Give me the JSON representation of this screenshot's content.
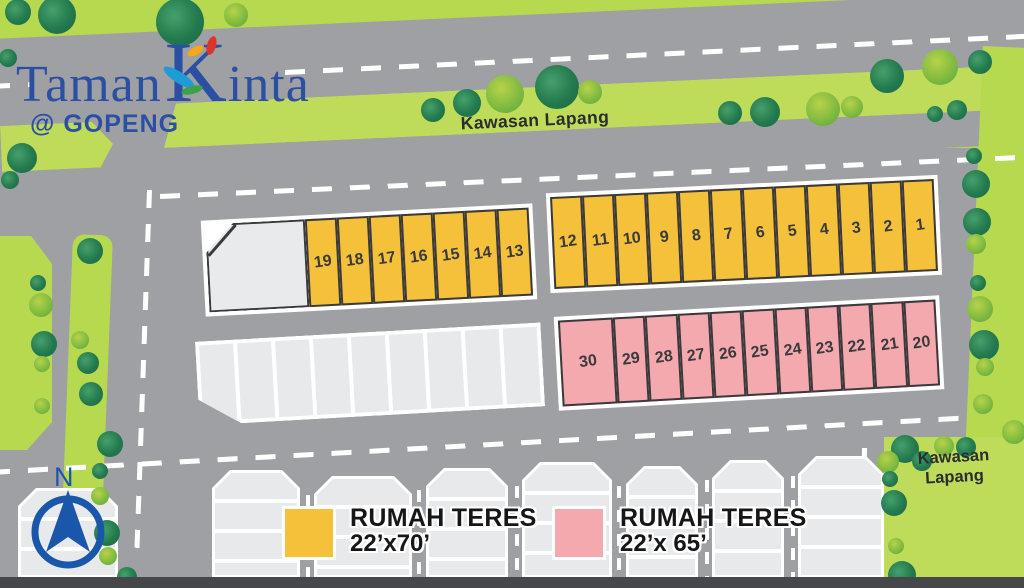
{
  "logo": {
    "word1": "Taman",
    "k": "K",
    "word2": "inta",
    "subtitle": "@ GOPENG",
    "color": "#2b4fa3"
  },
  "labels": {
    "road_top": "Kawasan Lapang",
    "area_bottom_right_line1": "Kawasan",
    "area_bottom_right_line2": "Lapang",
    "compass_n": "N"
  },
  "legend": {
    "items": [
      {
        "swatch_color": "#f6c13a",
        "name": "RUMAH TERES",
        "size": "22’x70’"
      },
      {
        "swatch_color": "#f4a9ae",
        "name": "RUMAH TERES",
        "size": "22’x 65’"
      }
    ]
  },
  "site": {
    "strips": {
      "terrace70_left": {
        "house_type": "RUMAH TERES 22'x70'",
        "color": "#f6c13a",
        "corner_lot_first": true,
        "numbers": [
          "19",
          "18",
          "17",
          "16",
          "15",
          "14",
          "13"
        ]
      },
      "terrace70_right": {
        "house_type": "RUMAH TERES 22'x70'",
        "color": "#f6c13a",
        "corner_lot_first": false,
        "numbers": [
          "12",
          "11",
          "10",
          "9",
          "8",
          "7",
          "6",
          "5",
          "4",
          "3",
          "2",
          "1"
        ]
      },
      "terrace65": {
        "house_type": "RUMAH TERES 22'x 65'",
        "color": "#f4a9ae",
        "corner_lot_first": false,
        "first_wide": true,
        "numbers": [
          "30",
          "29",
          "28",
          "27",
          "26",
          "25",
          "24",
          "23",
          "22",
          "21",
          "20"
        ]
      },
      "unlabeled": {
        "color": "#e8e9eb",
        "count": 9
      }
    }
  },
  "colors": {
    "grass": "#b6d950",
    "road": "#9ea0a3",
    "lot_outline": "#3a3a3c",
    "terrace70": "#f6c13a",
    "terrace65": "#f4a9ae",
    "logo_blue": "#2b4fa3",
    "compass_blue": "#1a57ab"
  },
  "decor": {
    "trees": [
      {
        "x": 18,
        "y": 12,
        "r": 13,
        "t": "d"
      },
      {
        "x": 57,
        "y": 15,
        "r": 19,
        "t": "d"
      },
      {
        "x": 180,
        "y": 22,
        "r": 24,
        "t": "d"
      },
      {
        "x": 236,
        "y": 15,
        "r": 12,
        "t": "l"
      },
      {
        "x": 8,
        "y": 58,
        "r": 9,
        "t": "d"
      },
      {
        "x": 22,
        "y": 158,
        "r": 15,
        "t": "d"
      },
      {
        "x": 10,
        "y": 180,
        "r": 9,
        "t": "d"
      },
      {
        "x": 433,
        "y": 110,
        "r": 12,
        "t": "d"
      },
      {
        "x": 467,
        "y": 103,
        "r": 14,
        "t": "d"
      },
      {
        "x": 505,
        "y": 94,
        "r": 19,
        "t": "l"
      },
      {
        "x": 557,
        "y": 87,
        "r": 22,
        "t": "d"
      },
      {
        "x": 590,
        "y": 92,
        "r": 12,
        "t": "l"
      },
      {
        "x": 730,
        "y": 113,
        "r": 12,
        "t": "d"
      },
      {
        "x": 765,
        "y": 112,
        "r": 15,
        "t": "d"
      },
      {
        "x": 823,
        "y": 109,
        "r": 17,
        "t": "l"
      },
      {
        "x": 852,
        "y": 107,
        "r": 11,
        "t": "l"
      },
      {
        "x": 887,
        "y": 76,
        "r": 17,
        "t": "d"
      },
      {
        "x": 940,
        "y": 67,
        "r": 18,
        "t": "l"
      },
      {
        "x": 980,
        "y": 62,
        "r": 12,
        "t": "d"
      },
      {
        "x": 935,
        "y": 114,
        "r": 8,
        "t": "d"
      },
      {
        "x": 957,
        "y": 110,
        "r": 10,
        "t": "d"
      },
      {
        "x": 974,
        "y": 156,
        "r": 8,
        "t": "d"
      },
      {
        "x": 976,
        "y": 184,
        "r": 14,
        "t": "d"
      },
      {
        "x": 977,
        "y": 222,
        "r": 14,
        "t": "d"
      },
      {
        "x": 976,
        "y": 244,
        "r": 10,
        "t": "l"
      },
      {
        "x": 978,
        "y": 283,
        "r": 8,
        "t": "d"
      },
      {
        "x": 980,
        "y": 309,
        "r": 13,
        "t": "l"
      },
      {
        "x": 984,
        "y": 345,
        "r": 15,
        "t": "d"
      },
      {
        "x": 985,
        "y": 367,
        "r": 9,
        "t": "l"
      },
      {
        "x": 983,
        "y": 404,
        "r": 10,
        "t": "l"
      },
      {
        "x": 905,
        "y": 449,
        "r": 14,
        "t": "d"
      },
      {
        "x": 922,
        "y": 461,
        "r": 10,
        "t": "d"
      },
      {
        "x": 888,
        "y": 462,
        "r": 11,
        "t": "l"
      },
      {
        "x": 890,
        "y": 479,
        "r": 8,
        "t": "d"
      },
      {
        "x": 894,
        "y": 503,
        "r": 13,
        "t": "d"
      },
      {
        "x": 896,
        "y": 546,
        "r": 8,
        "t": "l"
      },
      {
        "x": 902,
        "y": 575,
        "r": 14,
        "t": "d"
      },
      {
        "x": 944,
        "y": 446,
        "r": 10,
        "t": "l"
      },
      {
        "x": 966,
        "y": 447,
        "r": 10,
        "t": "d"
      },
      {
        "x": 1014,
        "y": 432,
        "r": 12,
        "t": "l"
      },
      {
        "x": 90,
        "y": 251,
        "r": 13,
        "t": "d"
      },
      {
        "x": 38,
        "y": 283,
        "r": 8,
        "t": "d"
      },
      {
        "x": 41,
        "y": 305,
        "r": 12,
        "t": "l"
      },
      {
        "x": 44,
        "y": 344,
        "r": 13,
        "t": "d"
      },
      {
        "x": 80,
        "y": 340,
        "r": 9,
        "t": "l"
      },
      {
        "x": 42,
        "y": 364,
        "r": 8,
        "t": "l"
      },
      {
        "x": 88,
        "y": 363,
        "r": 11,
        "t": "d"
      },
      {
        "x": 91,
        "y": 394,
        "r": 12,
        "t": "d"
      },
      {
        "x": 42,
        "y": 406,
        "r": 8,
        "t": "l"
      },
      {
        "x": 110,
        "y": 444,
        "r": 13,
        "t": "d"
      },
      {
        "x": 100,
        "y": 471,
        "r": 8,
        "t": "d"
      },
      {
        "x": 100,
        "y": 496,
        "r": 9,
        "t": "l"
      },
      {
        "x": 107,
        "y": 533,
        "r": 13,
        "t": "d"
      },
      {
        "x": 108,
        "y": 556,
        "r": 9,
        "t": "l"
      },
      {
        "x": 127,
        "y": 577,
        "r": 10,
        "t": "d"
      }
    ],
    "houses": [
      {
        "x": 18,
        "w": 100,
        "top": 488
      },
      {
        "x": 212,
        "w": 88,
        "top": 470
      },
      {
        "x": 314,
        "w": 98,
        "top": 476
      },
      {
        "x": 426,
        "w": 82,
        "top": 468
      },
      {
        "x": 522,
        "w": 90,
        "top": 462
      },
      {
        "x": 626,
        "w": 72,
        "top": 466
      },
      {
        "x": 712,
        "w": 72,
        "top": 460
      },
      {
        "x": 798,
        "w": 86,
        "top": 456
      }
    ],
    "gap_dashes": [
      {
        "x": 306,
        "y": 495
      },
      {
        "x": 417,
        "y": 490
      },
      {
        "x": 515,
        "y": 486
      },
      {
        "x": 617,
        "y": 486
      },
      {
        "x": 705,
        "y": 480
      },
      {
        "x": 791,
        "y": 476
      }
    ]
  }
}
